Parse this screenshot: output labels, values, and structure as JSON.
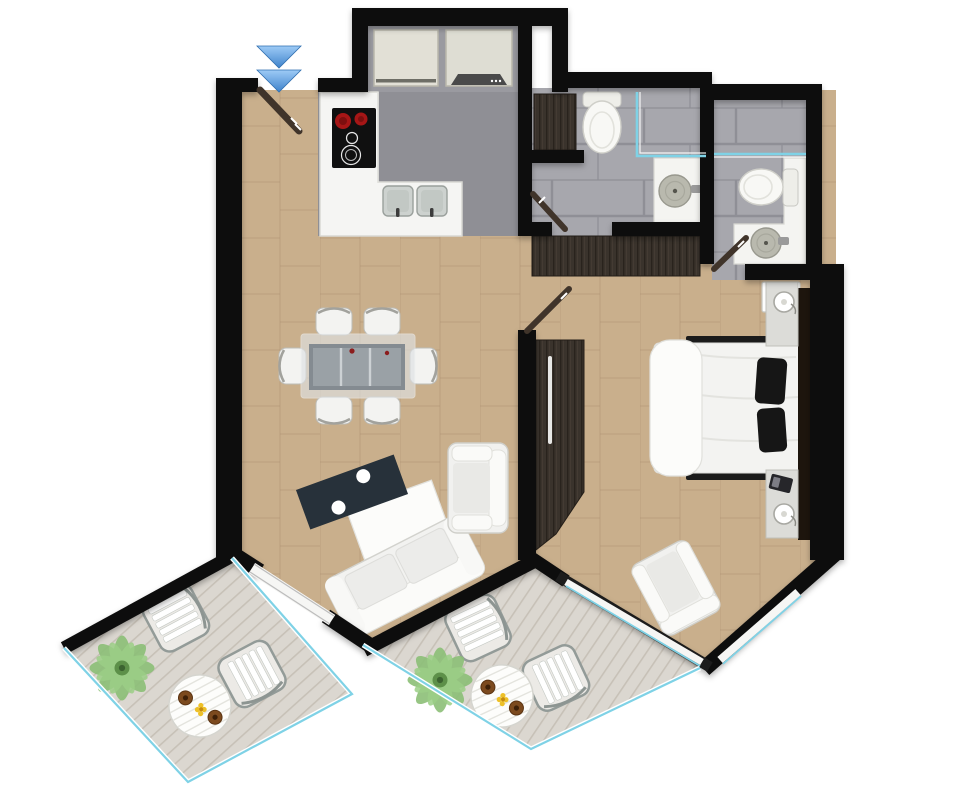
{
  "meta": {
    "type": "apartment-floor-plan",
    "orientation": "top-down",
    "visible_text": "none"
  },
  "colors": {
    "wall": "#0d0d0d",
    "floor_cork": "#c9af8c",
    "floor_cork_joint": "#ab9070",
    "floor_tile": "#a7a7ad",
    "floor_tile_joint": "#8f8f96",
    "floor_kitchen": "#8f8f95",
    "floor_deck": "#dbd7d0",
    "deck_plank": "#c7c1b7",
    "glass": "#7fd2e6",
    "wood_dark": "#3a332c",
    "door_leaf": "#40342a",
    "furniture_white": "#f2f2f0",
    "coffee_table": "#27313a",
    "burner_red": "#a61616",
    "plant_green": "#8cbf77",
    "entry_arrow": "#5c9fe0",
    "plate_brown": "#7c4a1e",
    "flower_yellow": "#edc028"
  },
  "entry": {
    "marker": "double-chevron-down",
    "door": "single-leaf-diagonal"
  },
  "rooms": [
    {
      "id": "living-dining",
      "label": "Living / Dining",
      "floor": "cork-tile"
    },
    {
      "id": "kitchen",
      "label": "Kitchen",
      "floor": "grey"
    },
    {
      "id": "bathroom-1",
      "label": "Bathroom 1",
      "floor": "grey-tile"
    },
    {
      "id": "bathroom-2",
      "label": "Bathroom 2",
      "floor": "grey-tile"
    },
    {
      "id": "bedroom",
      "label": "Bedroom",
      "floor": "cork-tile"
    },
    {
      "id": "balcony-1",
      "label": "Balcony left",
      "floor": "timber-deck"
    },
    {
      "id": "balcony-2",
      "label": "Balcony right",
      "floor": "timber-deck"
    }
  ],
  "furniture": {
    "kitchen": [
      "l-shaped-counter",
      "cooktop-4-zone",
      "double-sink",
      "fridge",
      "oven-unit"
    ],
    "living_dining": [
      "glass-dining-table",
      "dining-chair-x6",
      "dark-media-unit",
      "white-rug-panel",
      "sofa-3-seat",
      "armchair"
    ],
    "bathroom_1": [
      "toilet",
      "shower-glass-screen",
      "vanity-round-basin",
      "tall-cabinet",
      "hall-wardrobe"
    ],
    "bathroom_2": [
      "shower-glass-screen",
      "toilet",
      "vanity-round-basin",
      "washer"
    ],
    "bedroom": [
      "double-bed",
      "black-pillow-x2",
      "headboard",
      "nightstand-lamp-x2",
      "telephone",
      "sliding-wardrobe",
      "armchair"
    ],
    "balcony_1": [
      "outdoor-chair-x2",
      "round-slat-table",
      "plate-x2",
      "flower-dish",
      "potted-plant"
    ],
    "balcony_2": [
      "outdoor-chair-x2",
      "round-slat-table",
      "plate-x2",
      "flower-dish",
      "potted-plant"
    ]
  }
}
